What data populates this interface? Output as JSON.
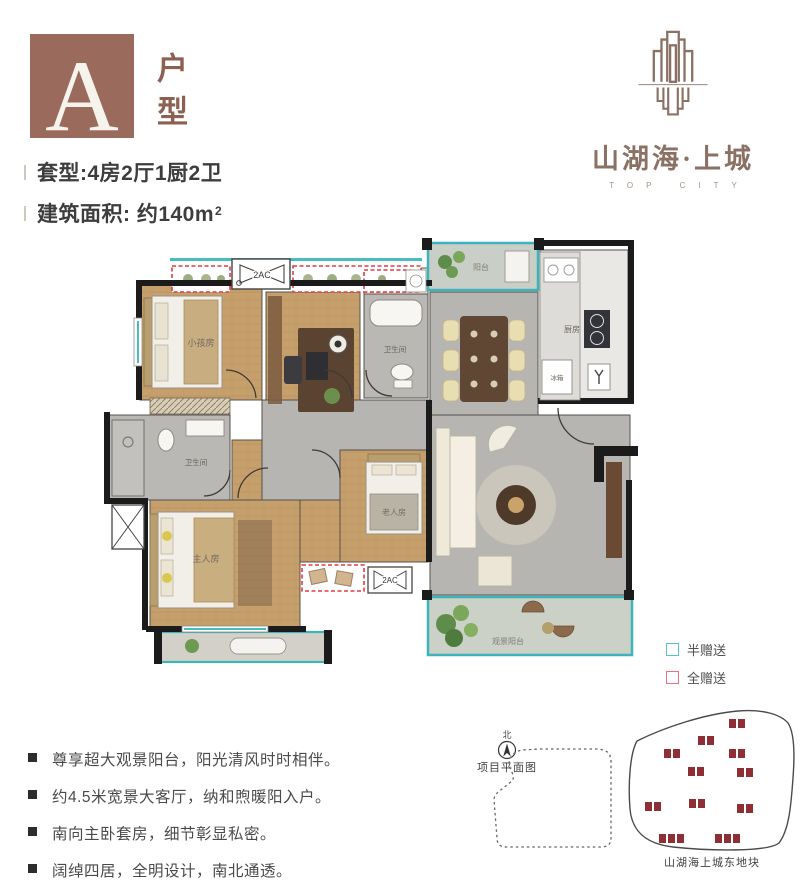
{
  "header": {
    "unit_letter": "A",
    "unit_type_label": "户型",
    "spec_line1": "套型:4房2厅1厨2卫",
    "spec_area_prefix": "建筑面积: 约140m",
    "spec_area_sup": "2"
  },
  "logo": {
    "name": "山湖海·上城",
    "subtitle": "TOP CITY",
    "brand_color": "#8a7164"
  },
  "floorplan": {
    "labels": {
      "kids_room": "小孩房",
      "bathroom_public": "卫生间",
      "bathroom_master": "卫生间",
      "kitchen": "厨房",
      "fridge": "冰箱",
      "balcony_top": "阳台",
      "master_room": "主人房",
      "elder_room": "老人房",
      "view_balcony": "观景阳台",
      "ac_top": "2AC",
      "ac_bottom": "2AC"
    },
    "colors": {
      "half_gift_teal": "#3db4bb",
      "full_gift_red": "#e23b43",
      "wall_black": "#1b1b1b"
    }
  },
  "legend": {
    "items": [
      {
        "label": "半赠送",
        "color": "#5bc2c5"
      },
      {
        "label": "全赠送",
        "color": "#e4737e"
      }
    ]
  },
  "features": {
    "items": [
      "尊享超大观景阳台，阳光清风时时相伴。",
      "约4.5米宽景大客厅，纳和煦暖阳入户。",
      "南向主卧套房，细节彰显私密。",
      "阔绰四居，全明设计，南北通透。"
    ]
  },
  "siteplan": {
    "north_label": "北",
    "title": "项目平面图",
    "parcel_label": "山湖海上城东地块"
  }
}
